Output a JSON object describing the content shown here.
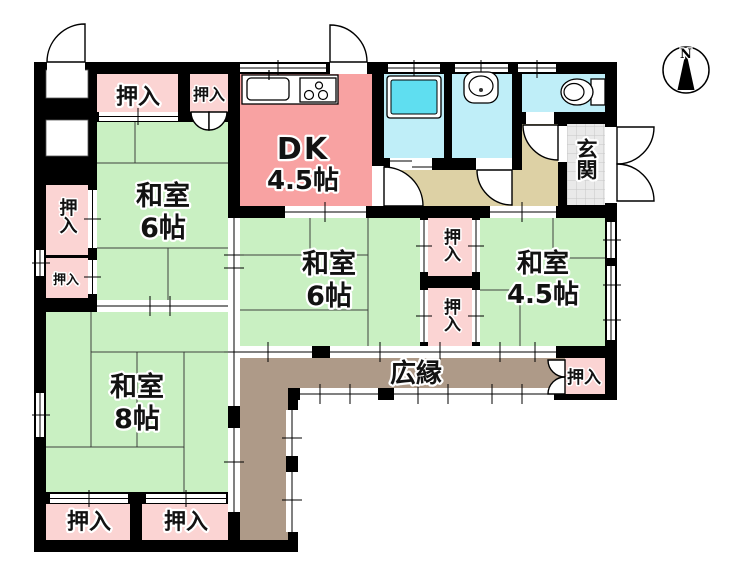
{
  "plan": {
    "compass": {
      "label": "N"
    },
    "labels": {
      "closet": "押入",
      "hiroen": "広縁",
      "genkan": "玄関"
    },
    "rooms": {
      "dk": {
        "name": "DK",
        "size": "4.5帖"
      },
      "washitsu_nw": {
        "name": "和室",
        "size": "6帖"
      },
      "washitsu_center": {
        "name": "和室",
        "size": "6帖"
      },
      "washitsu_east": {
        "name": "和室",
        "size": "4.5帖"
      },
      "washitsu_sw": {
        "name": "和室",
        "size": "8帖"
      }
    },
    "colors": {
      "wall": "#000000",
      "tatami_green": "#c9f0c2",
      "dk_pink": "#f8a2a2",
      "closet_pink": "#fbd4d3",
      "hiroen_taupe": "#ae9a88",
      "hallway_tan": "#ddd1a5",
      "wet_area_cyan": "#bfeef8",
      "bathtub_cyan": "#5fdef0",
      "genkan_gray": "#e9e9e9"
    },
    "icons": {
      "compass": "compass-north-icon",
      "kitchen_sink": "kitchen-sink-icon",
      "stove": "stove-icon",
      "bathtub": "bathtub-icon",
      "washbasin": "washbasin-icon",
      "toilet": "toilet-icon"
    }
  }
}
